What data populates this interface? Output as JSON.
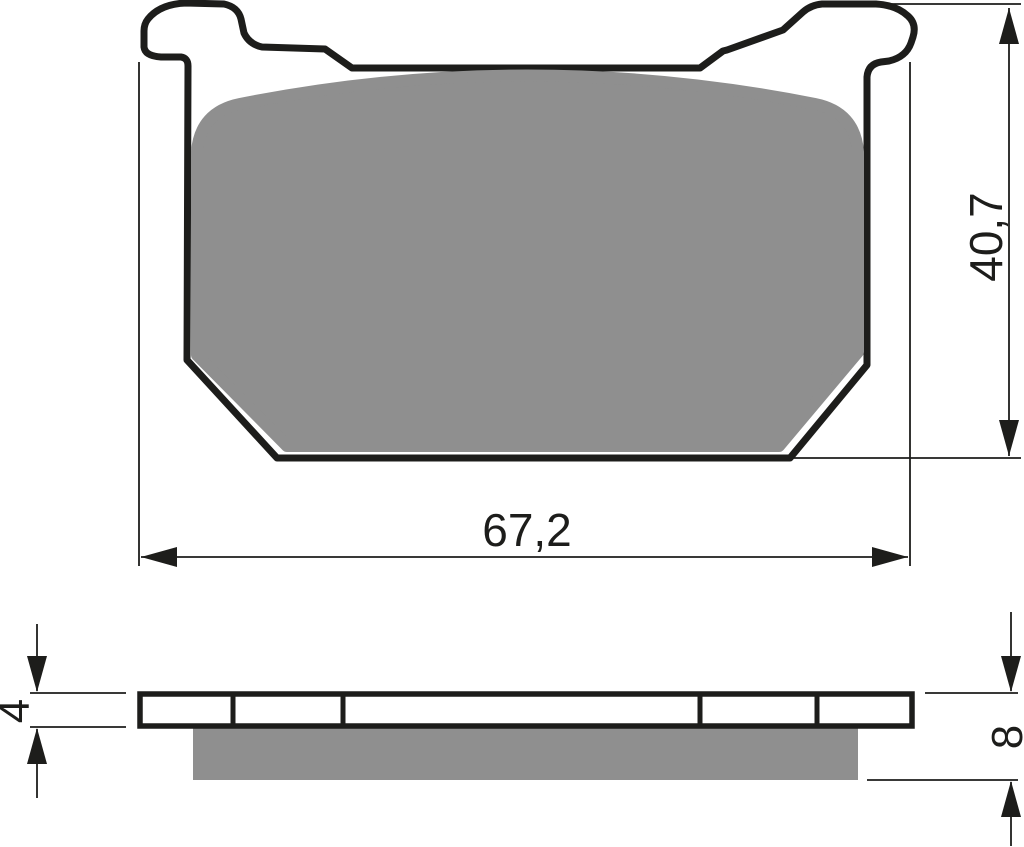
{
  "drawing": {
    "type": "brake-pad-technical-drawing",
    "views": {
      "top_view": "pad-face-profile",
      "side_view": "pad-edge-section"
    },
    "dimensions": {
      "width": {
        "label": "67,2",
        "unit_system": "mm-implied"
      },
      "height": {
        "label": "40,7",
        "unit_system": "mm-implied"
      },
      "backplate_thickness": {
        "label": "4",
        "unit_system": "mm-implied"
      },
      "total_thickness": {
        "label": "8",
        "unit_system": "mm-implied"
      }
    },
    "colors": {
      "outline": "#1d1d1b",
      "friction_material": "#8f8f8f",
      "background": "#ffffff"
    }
  }
}
